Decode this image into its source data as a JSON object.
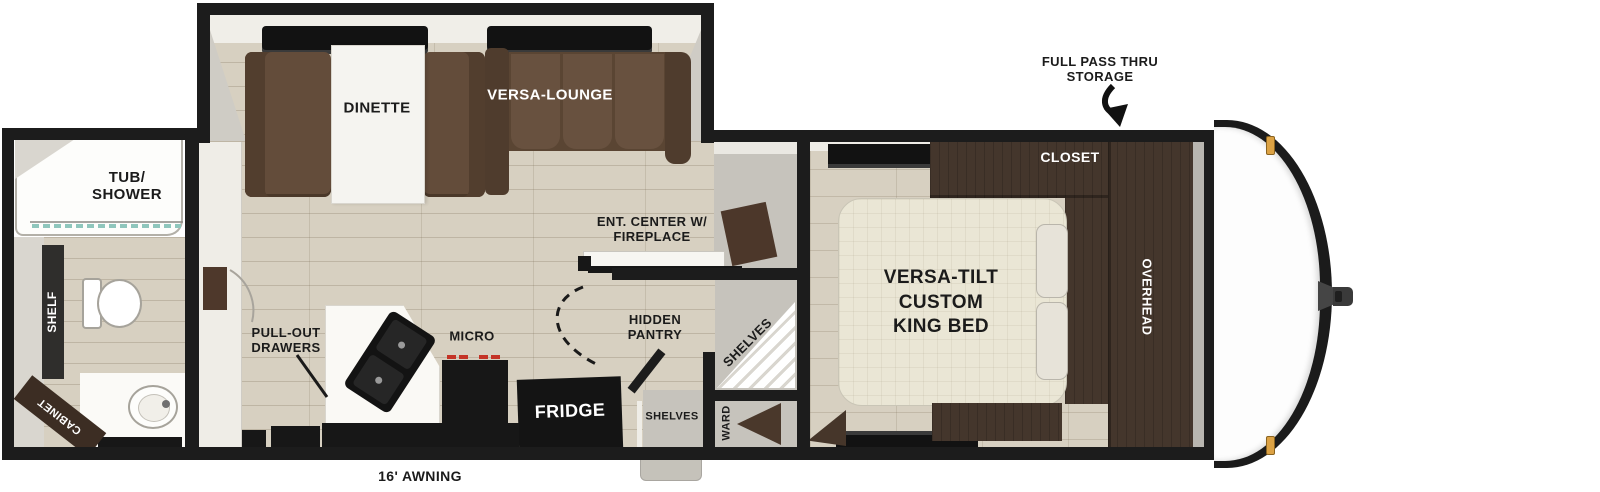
{
  "title": "Travel trailer floorplan",
  "colors": {
    "wall": "#1c1c1c",
    "floor_plank": "#d7d0c1",
    "dark_wood": "#44362c",
    "sofa_brown": "#634c3a",
    "bed_cream": "#eae6d5",
    "shower_glass_teal": "#8fc6bc",
    "burner_red": "#c43326",
    "marker_light_amber": "#dca244"
  },
  "labels": {
    "awning": "16' AWNING",
    "full_pass_thru": "FULL PASS THRU\nSTORAGE",
    "bathroom": {
      "tub_shower": "TUB/\nSHOWER",
      "shelf": "SHELF",
      "cabinet": "CABINET"
    },
    "living": {
      "dinette": "DINETTE",
      "versa_lounge": "VERSA-LOUNGE",
      "ent_center": "ENT. CENTER W/\nFIREPLACE"
    },
    "kitchen": {
      "pull_out_drawers": "PULL-OUT\nDRAWERS",
      "micro": "MICRO",
      "fridge": "FRIDGE",
      "hidden_pantry": "HIDDEN\nPANTRY",
      "corner_shelves": "SHELVES",
      "pantry_shelves": "SHELVES",
      "ward": "WARD"
    },
    "bedroom": {
      "bed": "VERSA-TILT\nCUSTOM\nKING BED",
      "closet": "CLOSET",
      "overhead": "OVERHEAD"
    }
  }
}
